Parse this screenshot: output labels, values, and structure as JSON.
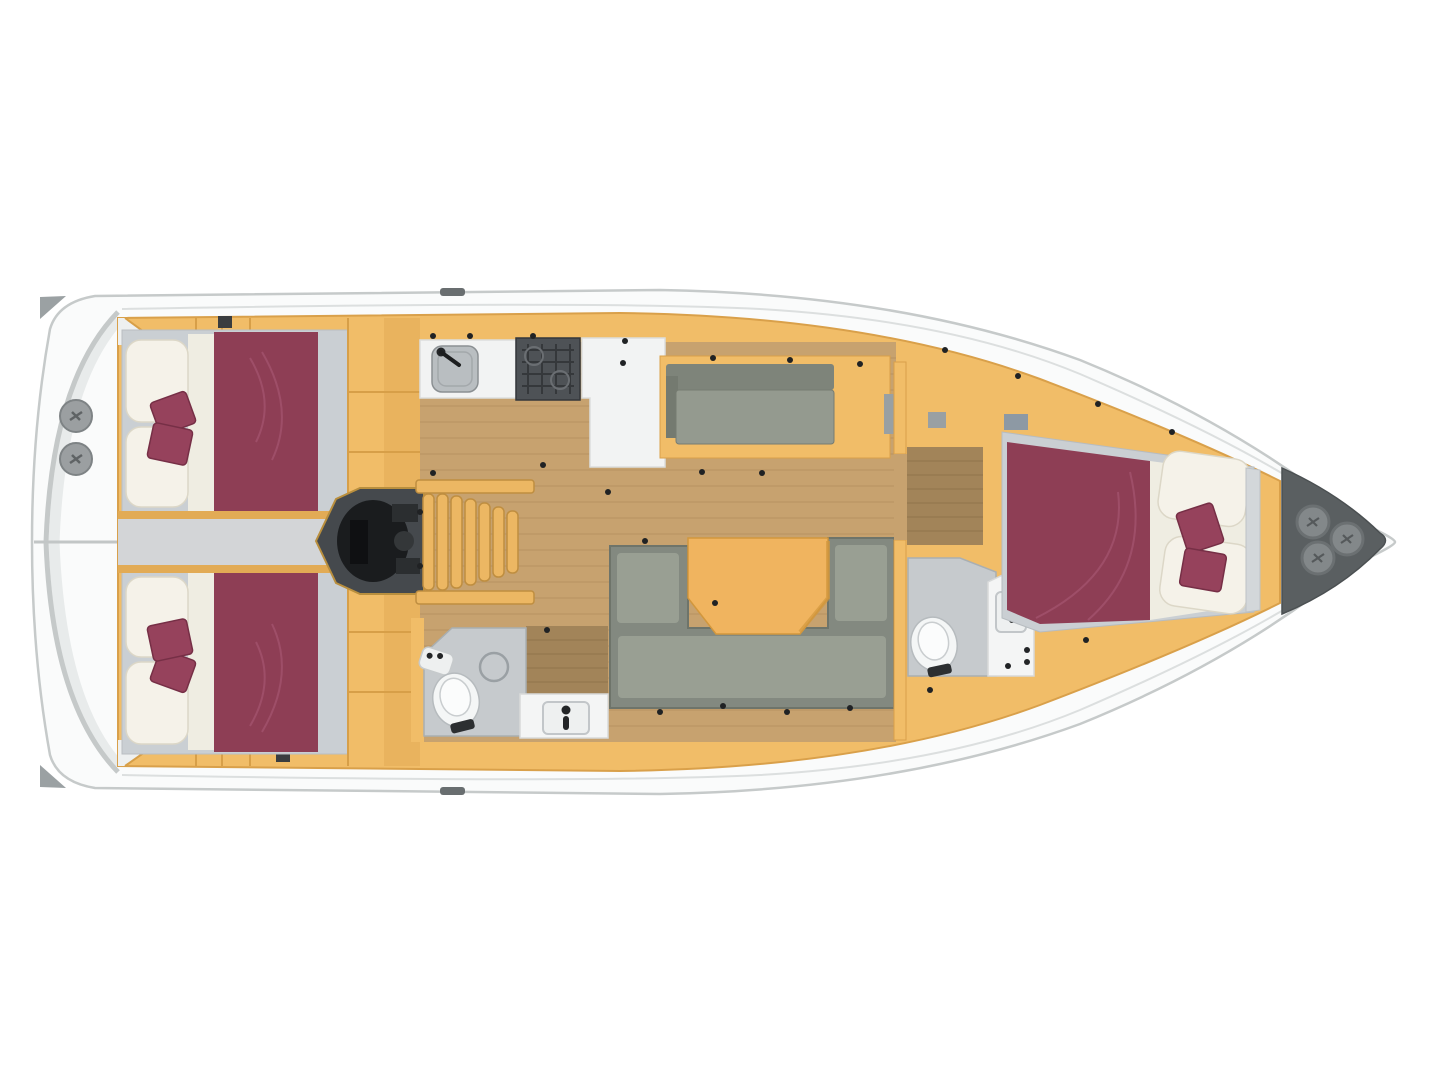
{
  "meta": {
    "type": "floor-plan",
    "subject": "sailing-yacht-interior-layout",
    "view": "top-down",
    "visible_text": "none"
  },
  "colors": {
    "background": "#ffffff",
    "hull_fill": "#fafbfb",
    "hull_stroke": "#c6caca",
    "deck_line": "#dcdfdf",
    "arc_gray": "#c5c9c9",
    "platform_band": "#e4e7e8",
    "corner_cap": "#9ba1a3",
    "cleat": "#696e70",
    "joinery": "#f1bd68",
    "joinery_shade": "#e2ab55",
    "joinery_dark": "#d79f48",
    "corridor": "#d3d5d7",
    "wood_floor": "#c7a26f",
    "wood_line": "#ad8c5c",
    "wood_dark": "#a28459",
    "wood_dark_line": "#8a7048",
    "stairs": "#ecb763",
    "stairs_edge": "#bf8e40",
    "engine_box": "#45494d",
    "engine_black": "#1a1c1e",
    "bed_base": "#cacfd3",
    "pillow": "#f5f2e9",
    "pillow_edge": "#dcd7c7",
    "sheet": "#efede2",
    "duvet": "#8e3e55",
    "duvet_line": "#a85873",
    "cushion": "#96425c",
    "cushion_edge": "#762f46",
    "settee_back": "#7e847a",
    "settee_seat": "#949a8f",
    "sofa_outer": "#838980",
    "sofa_inner": "#999f93",
    "sofa_rim": "#6e746a",
    "table": "#f0b45f",
    "table_edge": "#d2973d",
    "counter": "#f2f3f3",
    "counter_edge": "#dcdede",
    "sink": "#b9bec1",
    "sink_edge": "#8b9093",
    "stove": "#4e5256",
    "stove_grid": "#35383b",
    "bath_floor": "#c6cacd",
    "bath_edge": "#a9afb2",
    "toilet": "#f4f6f6",
    "toilet_edge": "#b6bbbe",
    "fixture": "#232527",
    "vanity": "#f4f5f5",
    "basin_edge": "#c2c6c9",
    "locker_gray": "#99a0a3",
    "drawer_blue": "#8d99a4",
    "bow_locker": "#5a5f61",
    "hatch": "#83888a",
    "hatch_edge": "#6b7072",
    "winch": "#9b9fa1",
    "winch_edge": "#7e8385",
    "dot": "#202224",
    "wall_white": "#eef0f0",
    "dark_locker": "#3a3d3f"
  },
  "components": [
    "hull-outline",
    "stern-swim-platform",
    "stern-winches",
    "aft-cabin-top-double-bed",
    "aft-cabin-bottom-double-bed",
    "engine-compartment",
    "companionway-stairs",
    "galley-sink",
    "galley-stove",
    "galley-counter-unit",
    "saloon-wood-floor",
    "top-settee",
    "u-shaped-sofa",
    "saloon-table",
    "aft-head-toilet",
    "aft-head-shower",
    "aft-head-vanity",
    "forward-passage-wardrobe",
    "forward-head-toilet",
    "forward-head-vanity",
    "forward-cabin-double-bed",
    "bow-anchor-locker",
    "bow-hatches"
  ]
}
